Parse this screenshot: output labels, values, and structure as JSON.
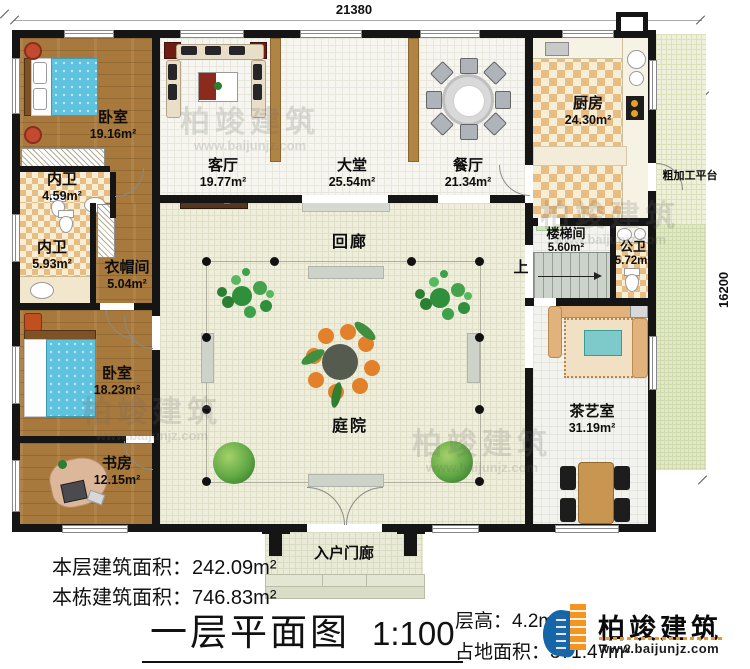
{
  "dimensions": {
    "width_top": "21380",
    "height_right": "16200"
  },
  "rooms": {
    "bedroom1": {
      "name": "卧室",
      "area": "19.16m²"
    },
    "bath1": {
      "name": "内卫",
      "area": "4.59m²"
    },
    "living": {
      "name": "客厅",
      "area": "19.77m²"
    },
    "hall": {
      "name": "大堂",
      "area": "25.54m²"
    },
    "dining": {
      "name": "餐厅",
      "area": "21.34m²"
    },
    "kitchen": {
      "name": "厨房",
      "area": "24.30m²"
    },
    "platform": {
      "name": "粗加工平台"
    },
    "bath2": {
      "name": "内卫",
      "area": "5.93m²"
    },
    "cloak": {
      "name": "衣帽间",
      "area": "5.04m²"
    },
    "corridor": {
      "name": "回廊"
    },
    "stair": {
      "name": "楼梯间",
      "area": "5.60m²",
      "up": "上"
    },
    "bath3": {
      "name": "公卫",
      "area": "5.72m²"
    },
    "bedroom2": {
      "name": "卧室",
      "area": "18.23m²"
    },
    "study": {
      "name": "书房",
      "area": "12.15m²"
    },
    "courtyard": {
      "name": "庭院"
    },
    "tea": {
      "name": "茶艺室",
      "area": "31.19m²"
    },
    "porch": {
      "name": "入户门廊"
    }
  },
  "stats": {
    "floor_area_label": "本层建筑面积：",
    "floor_area_value": "242.09m²",
    "building_area_label": "本栋建筑面积：",
    "building_area_value": "746.83m²",
    "floor_height_label": "层高：",
    "floor_height_value": "4.2m",
    "land_area_label": "占地面积：",
    "land_area_value": "371.47m²"
  },
  "title": {
    "main": "一层平面图",
    "scale": "1:100"
  },
  "brand": {
    "name": "柏竣建筑",
    "url": "www.baijunjz.com"
  },
  "watermark": {
    "name": "柏竣建筑",
    "url": "www.baijunjz.com"
  },
  "colors": {
    "wall": "#151515",
    "brand_blue": "#1565a8",
    "brand_orange": "#f5941f",
    "bed_blue": "#5fc2de",
    "wood": "#a8793c"
  }
}
